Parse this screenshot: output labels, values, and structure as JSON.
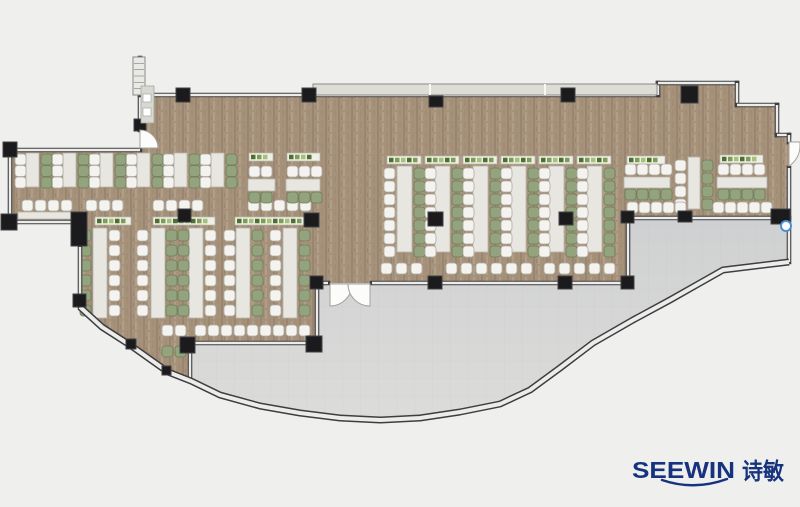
{
  "logo": {
    "latin": "SEEWIN",
    "cjk": "诗敏",
    "color": "#17337f"
  },
  "palette": {
    "bg": "#eff0ee",
    "floor": "#a6927a",
    "floor_streaks": [
      "#9a8670",
      "#b19e88",
      "#a28d75"
    ],
    "terrace_top": "#cfd0d1",
    "terrace_bottom": "#dcdcda",
    "tile_line": "#c2c3c4",
    "wall_dark": "#3e3e40",
    "wall_light": "#ececea",
    "wall_mid": "#8a8a88",
    "window": "#dddcd5",
    "column": "#1b1b1d",
    "column_stroke": "#404042",
    "table": "#e8e6e0",
    "table_border": "#b7b4ab",
    "chair_white": "#f4f3ef",
    "chair_white_border": "#aeaca3",
    "chair_green": "#93a37d",
    "chair_green_border": "#6e7e5a",
    "planter_bg": "#eef0e8",
    "planter_border": "#b4b8a8",
    "plants": [
      "#4f6f2f",
      "#7f9c55",
      "#a9c07d"
    ],
    "door_fill": "#fcfcfb",
    "door_stroke": "#a2a2a0",
    "fixture_blue": "#4a8fd4"
  },
  "floorplan": {
    "brown_floor": "140,95 658,95 658,83 737,83 737,105 777,105 777,135 789,135 789,218 628,218 628,283 317,283 317,343 190,343 191,381 168,372 130,345 102,327 80,307 80,222 10,222 10,150 140,150",
    "terrace": "190,343 317,343 317,283 628,283 628,218 789,218 789,262 723,270 700,283 670,300 633,320 593,343 560,368 530,390 500,404 460,412 420,418 380,420 340,418 300,413 260,406 220,395 191,381",
    "arc": "80,307 102,327 130,345 168,372 191,381 220,395 260,406 300,413 340,418 380,420 420,418 460,412 500,404 530,390 560,368 593,343 633,320 670,300 700,283 723,270 789,262",
    "walls": [
      [
        150,
        95,
        658,
        95
      ],
      [
        658,
        95,
        658,
        83
      ],
      [
        658,
        83,
        737,
        83
      ],
      [
        737,
        83,
        737,
        105
      ],
      [
        737,
        105,
        777,
        105
      ],
      [
        777,
        105,
        777,
        135
      ],
      [
        777,
        135,
        789,
        135
      ],
      [
        789,
        135,
        789,
        142
      ],
      [
        789,
        168,
        789,
        262
      ],
      [
        628,
        218,
        789,
        218
      ],
      [
        628,
        218,
        628,
        283
      ],
      [
        317,
        283,
        328,
        283
      ],
      [
        372,
        283,
        628,
        283
      ],
      [
        317,
        283,
        317,
        343
      ],
      [
        190,
        343,
        317,
        343
      ],
      [
        190,
        343,
        190,
        381
      ],
      [
        140,
        95,
        140,
        130
      ],
      [
        10,
        150,
        140,
        150
      ],
      [
        10,
        150,
        10,
        222
      ],
      [
        10,
        222,
        77,
        222
      ],
      [
        80,
        247,
        80,
        307
      ],
      [
        140,
        58,
        140,
        95
      ]
    ],
    "window_band": {
      "x": 313,
      "y": 84,
      "w": 344,
      "h": 11,
      "dividers": [
        430,
        545
      ]
    },
    "columns": [
      [
        176,
        88,
        14,
        14
      ],
      [
        302,
        88,
        14,
        14
      ],
      [
        429,
        96,
        14,
        11
      ],
      [
        561,
        88,
        14,
        14
      ],
      [
        681,
        86,
        17,
        17
      ],
      [
        134,
        119,
        12,
        12
      ],
      [
        3,
        142,
        14,
        15
      ],
      [
        1,
        214,
        16,
        16
      ],
      [
        71,
        212,
        16,
        34
      ],
      [
        73,
        294,
        13,
        13
      ],
      [
        178,
        209,
        13,
        13
      ],
      [
        304,
        213,
        15,
        14
      ],
      [
        428,
        212,
        15,
        14
      ],
      [
        559,
        212,
        14,
        13
      ],
      [
        310,
        276,
        13,
        13
      ],
      [
        428,
        276,
        14,
        13
      ],
      [
        558,
        276,
        14,
        13
      ],
      [
        621,
        276,
        13,
        13
      ],
      [
        621,
        211,
        13,
        12
      ],
      [
        678,
        211,
        14,
        11
      ],
      [
        771,
        209,
        19,
        15
      ],
      [
        180,
        337,
        15,
        16
      ],
      [
        306,
        336,
        16,
        16
      ],
      [
        126,
        339,
        10,
        10
      ],
      [
        162,
        366,
        9,
        9
      ]
    ],
    "doors": [
      "M330,284 L330,306 A22,22 0 0 0 352,284 Z",
      "M370,284 L370,306 A22,22 0 0 1 348,284 Z",
      "M140,148 L158,148 A18,18 0 0 0 140,130 Z",
      "M789,142 L789,166 A24,24 0 0 0 800,147 L800,142 Z"
    ],
    "stair": {
      "x": 133,
      "y": 57,
      "w": 12,
      "h": 38,
      "ticks": 5
    },
    "panel": {
      "x": 141,
      "y": 86,
      "w": 13,
      "h": 37,
      "squares": [
        [
          143,
          94
        ],
        [
          143,
          108
        ]
      ]
    },
    "fixture": {
      "cx": 786,
      "cy": 226,
      "r": 5
    },
    "furniture": {
      "tables_v": [
        [
          26,
          153,
          13,
          34
        ],
        [
          63,
          153,
          13,
          34
        ],
        [
          100,
          153,
          13,
          34
        ],
        [
          137,
          153,
          13,
          34
        ],
        [
          174,
          153,
          13,
          34
        ],
        [
          211,
          153,
          13,
          34
        ],
        [
          93,
          228,
          14,
          90
        ],
        [
          151,
          228,
          14,
          90
        ],
        [
          189,
          228,
          14,
          90
        ],
        [
          236,
          228,
          14,
          90
        ],
        [
          283,
          228,
          14,
          90
        ],
        [
          397,
          166,
          15,
          86
        ],
        [
          435,
          166,
          15,
          86
        ],
        [
          473,
          166,
          15,
          86
        ],
        [
          511,
          166,
          15,
          86
        ],
        [
          549,
          166,
          15,
          86
        ],
        [
          587,
          166,
          15,
          86
        ],
        [
          688,
          157,
          12,
          52
        ]
      ],
      "tables_h": [
        [
          248,
          179,
          27,
          12
        ],
        [
          286,
          179,
          34,
          12
        ],
        [
          624,
          177,
          46,
          11
        ],
        [
          717,
          177,
          50,
          11
        ],
        [
          18,
          212,
          58,
          7
        ]
      ],
      "planters_h": [
        [
          95,
          217,
          36,
          8
        ],
        [
          153,
          217,
          62,
          8
        ],
        [
          235,
          217,
          72,
          8
        ],
        [
          249,
          153,
          24,
          8
        ],
        [
          287,
          153,
          33,
          8
        ],
        [
          387,
          156,
          34,
          8
        ],
        [
          425,
          156,
          34,
          8
        ],
        [
          463,
          156,
          34,
          8
        ],
        [
          501,
          156,
          34,
          8
        ],
        [
          539,
          156,
          34,
          8
        ],
        [
          577,
          156,
          34,
          8
        ],
        [
          627,
          156,
          38,
          8
        ],
        [
          720,
          155,
          43,
          8
        ]
      ],
      "chair_cols": [
        [
          15,
          154,
          3,
          11.5,
          "w"
        ],
        [
          52,
          154,
          3,
          11.5,
          "w"
        ],
        [
          89,
          154,
          3,
          11.5,
          "w"
        ],
        [
          126,
          154,
          3,
          11.5,
          "w"
        ],
        [
          163,
          154,
          3,
          11.5,
          "w"
        ],
        [
          200,
          154,
          3,
          11.5,
          "w"
        ],
        [
          41,
          154,
          3,
          11.5,
          "g"
        ],
        [
          78,
          154,
          3,
          11.5,
          "g"
        ],
        [
          115,
          154,
          3,
          11.5,
          "g"
        ],
        [
          152,
          154,
          3,
          11.5,
          "g"
        ],
        [
          189,
          154,
          3,
          11.5,
          "g"
        ],
        [
          226,
          154,
          3,
          11.5,
          "g"
        ],
        [
          80,
          230,
          6,
          15,
          "g"
        ],
        [
          109,
          230,
          6,
          15,
          "w"
        ],
        [
          137,
          230,
          6,
          15,
          "w"
        ],
        [
          166,
          230,
          6,
          15,
          "g"
        ],
        [
          178,
          230,
          6,
          15,
          "g"
        ],
        [
          205,
          230,
          6,
          15,
          "w"
        ],
        [
          224,
          230,
          6,
          15,
          "w"
        ],
        [
          252,
          230,
          6,
          15,
          "g"
        ],
        [
          270,
          230,
          6,
          15,
          "w"
        ],
        [
          299,
          230,
          6,
          15,
          "g"
        ],
        [
          384,
          168,
          7,
          13,
          "w"
        ],
        [
          414,
          168,
          7,
          13,
          "g"
        ],
        [
          425,
          168,
          7,
          13,
          "w"
        ],
        [
          452,
          168,
          7,
          13,
          "g"
        ],
        [
          463,
          168,
          7,
          13,
          "w"
        ],
        [
          490,
          168,
          7,
          13,
          "g"
        ],
        [
          501,
          168,
          7,
          13,
          "w"
        ],
        [
          528,
          168,
          7,
          13,
          "g"
        ],
        [
          539,
          168,
          7,
          13,
          "w"
        ],
        [
          566,
          168,
          7,
          13,
          "g"
        ],
        [
          577,
          168,
          7,
          13,
          "w"
        ],
        [
          604,
          168,
          7,
          13,
          "g"
        ],
        [
          675,
          160,
          4,
          13,
          "w"
        ],
        [
          702,
          160,
          4,
          13,
          "g"
        ]
      ],
      "chair_rows": [
        [
          22,
          200,
          4,
          13,
          "w"
        ],
        [
          86,
          200,
          3,
          13,
          "w"
        ],
        [
          153,
          200,
          4,
          13,
          "w"
        ],
        [
          248,
          200,
          5,
          13,
          "w"
        ],
        [
          249,
          166,
          2,
          12,
          "w"
        ],
        [
          287,
          166,
          3,
          12,
          "w"
        ],
        [
          249,
          192,
          2,
          12,
          "g"
        ],
        [
          287,
          192,
          3,
          12,
          "g"
        ],
        [
          195,
          325,
          9,
          13,
          "w"
        ],
        [
          162,
          325,
          2,
          13,
          "w"
        ],
        [
          162,
          346,
          2,
          13,
          "g"
        ],
        [
          381,
          263,
          3,
          15,
          "w"
        ],
        [
          446,
          263,
          6,
          15,
          "w"
        ],
        [
          544,
          263,
          5,
          15,
          "w"
        ],
        [
          625,
          164,
          4,
          12,
          "w"
        ],
        [
          718,
          164,
          4,
          12,
          "w"
        ],
        [
          625,
          189,
          4,
          12,
          "g"
        ],
        [
          718,
          189,
          4,
          12,
          "g"
        ],
        [
          627,
          202,
          5,
          12,
          "w"
        ],
        [
          713,
          202,
          5,
          12,
          "w"
        ]
      ]
    }
  }
}
